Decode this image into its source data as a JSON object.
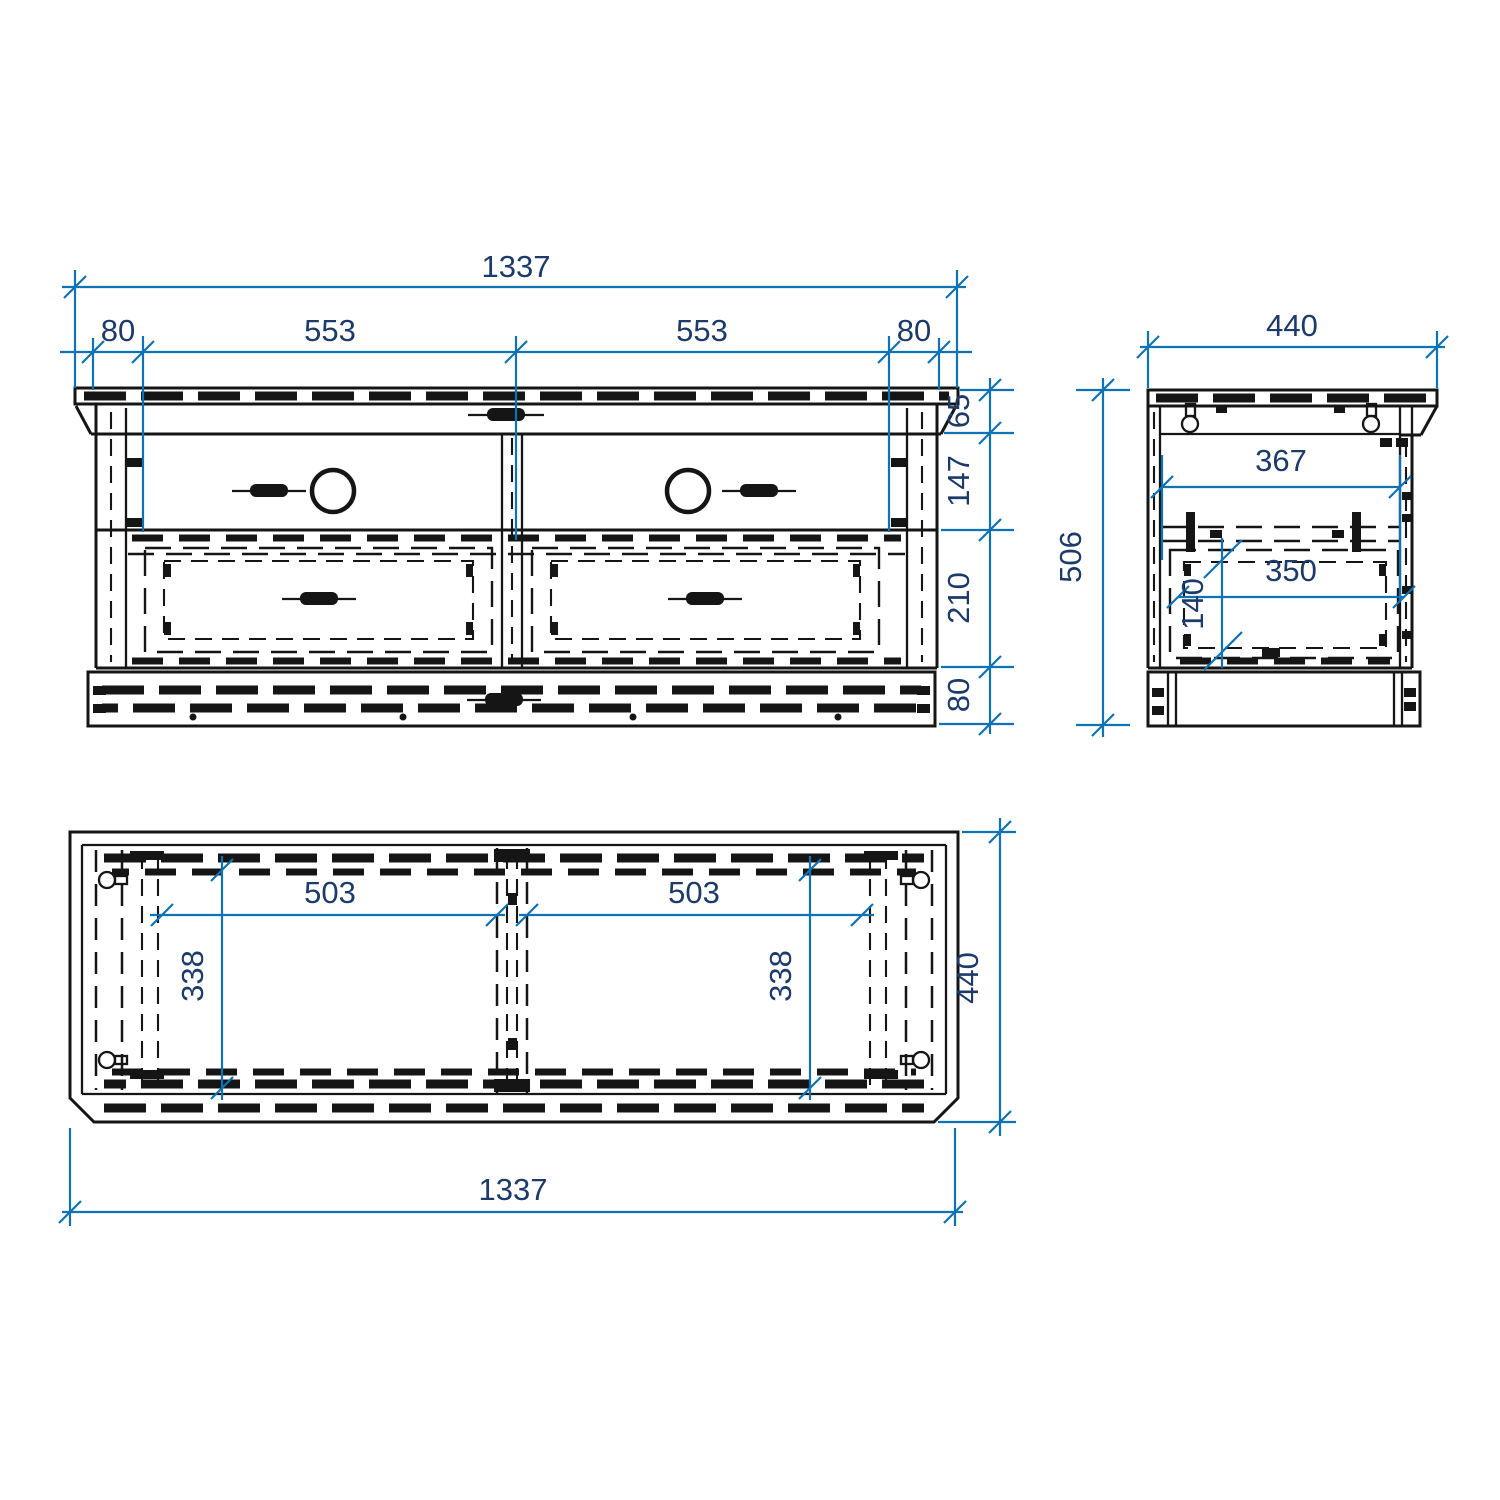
{
  "colors": {
    "geometry": "#151515",
    "dim_line": "#0e72b5",
    "dim_text": "#1c3a6a",
    "background": "#ffffff"
  },
  "front_view": {
    "overall_width": "1337",
    "left_offset": "80",
    "left_bay": "553",
    "right_bay": "553",
    "right_offset": "80",
    "top_height": "65",
    "upper_height": "147",
    "drawer_height": "210",
    "plinth_height": "80"
  },
  "side_view": {
    "depth": "440",
    "height": "506",
    "inner_depth": "367",
    "drawer_depth": "350",
    "drawer_inner_height": "140"
  },
  "top_view": {
    "left_bay_width": "503",
    "right_bay_width": "503",
    "left_bay_depth": "338",
    "right_bay_depth": "338",
    "depth": "440",
    "overall_width": "1337"
  }
}
